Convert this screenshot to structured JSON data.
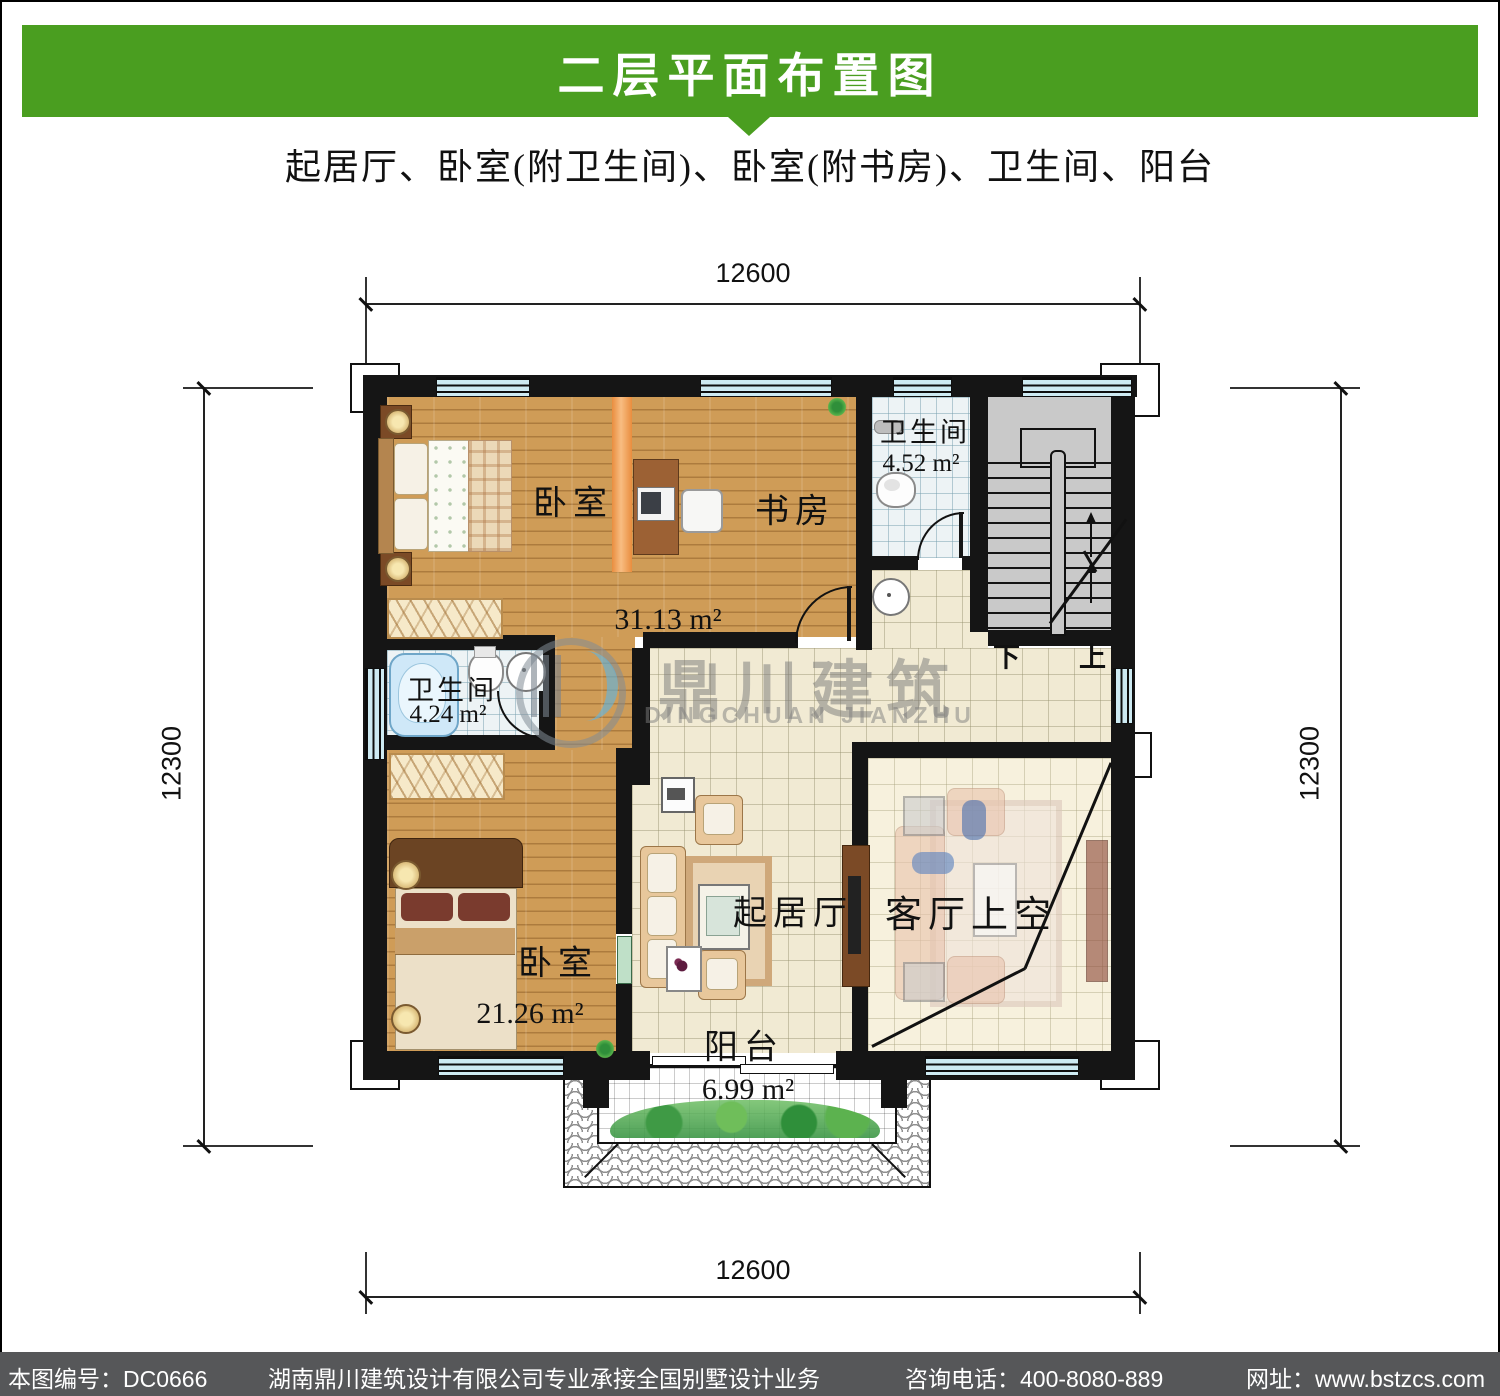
{
  "header": {
    "title": "二层平面布置图",
    "subtitle": "起居厅、卧室(附卫生间)、卧室(附书房)、卫生间、阳台",
    "banner_color": "#4a9e20"
  },
  "dims": {
    "top": "12600",
    "bottom": "12600",
    "left": "12300",
    "right": "12300"
  },
  "rooms": {
    "bedroom_top_label": "卧室",
    "study_label": "书房",
    "top_area": "31.13 m²",
    "bath_top_label": "卫生间",
    "bath_top_area": "4.52 m²",
    "bath_mid_label": "卫生间",
    "bath_mid_area": "4.24 m²",
    "bedroom_bottom_label": "卧室",
    "bedroom_bottom_area": "21.26 m²",
    "living_label": "起居厅",
    "void_label": "客厅上空",
    "balcony_label": "阳台",
    "balcony_area": "6.99 m²",
    "stair_down": "下",
    "stair_up": "上"
  },
  "watermark": {
    "cn": "鼎川建筑",
    "en": "DINGCHUAN JIANZHU"
  },
  "footer": {
    "drawing_no": "本图编号：DC0666",
    "company": "湖南鼎川建筑设计有限公司专业承接全国别墅设计业务",
    "phone": "咨询电话：400-8080-889",
    "website": "网址：www.bstzcs.com",
    "bg": "#565759"
  },
  "colors": {
    "wall": "#151515",
    "wood": "#cf9c57",
    "tile_cream": "#f1ead3",
    "tile_bath": "#edf3f5",
    "window": "#cdeaf2",
    "stair": "#c9c9c9",
    "accent_green": "#4a9e20",
    "footer_bg": "#565759"
  }
}
